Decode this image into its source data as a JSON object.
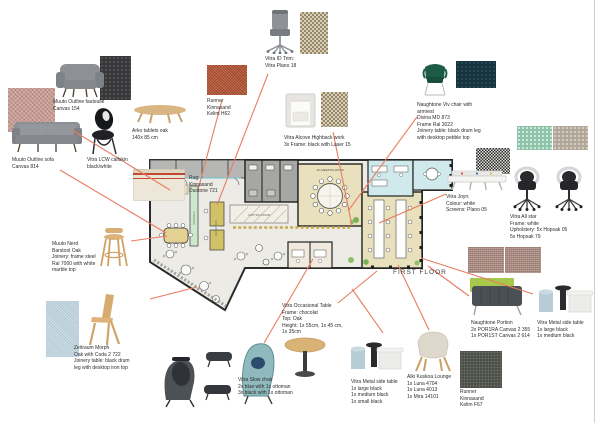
{
  "board": {
    "floor_label": "FIRST FLOOR",
    "accent_color": "#e87c5f",
    "plan": {
      "meeting_room": "12x MEETING ROOM",
      "copying_room": "COPYING ROOM",
      "reception": "RECEPTION",
      "entrance": "ENTRANCE"
    },
    "items": {
      "muuto_fauteuil": {
        "label": "Muuto Outline fauteuile\nCanvas 154"
      },
      "muuto_sofa": {
        "label": "Muuto Outline sofa\nCanvas 814"
      },
      "vitra_lcw": {
        "label": "Vitra LCW calfskin\nblack/white"
      },
      "arko": {
        "label": "Arko tablets oak\n140x 85 cm"
      },
      "runner_h62": {
        "label": "Runner\nKinnasand\nKelim H62"
      },
      "id_trim": {
        "label": "Vitra ID Trim:\nVitra Plano 18"
      },
      "alcove": {
        "label": "Vitra Alcove Highback work\n3x Frame: black with Laser 15"
      },
      "rug": {
        "label": "Rug:\nKinnasand\nDuotone 721"
      },
      "viv": {
        "label": "Naughtone Viv chair with\narmrest\nDivina MD 873\nFrame Ral 3022\nJoinery table: black drum leg\nwith desktop pebble top"
      },
      "joyn": {
        "label": "Vitra Joyn:\nColour: white\nScreens: Plano 05"
      },
      "allstar": {
        "label": "Vitra All star\nFrame: white",
        "label_bold": "Upholstery: 5x Hopsak 05\n5x Hopsak 79"
      },
      "nerd": {
        "label": "Muuto Nerd\nBarstool Oak\nJoinery: frame steel\nRal 7000 with white\nmarble top"
      },
      "morph": {
        "label": "Zeitraum Morph\nOak with Coda 2 722\nJoinery table: black drum\nleg with desktop iron top"
      },
      "slow": {
        "label": "Vitra Slow chair\n2x blue with 1x ottoman\n3x black with 1x ottoman"
      },
      "occasional": {
        "label": "Vitra Occasional Table\nFrame: chocolat\nTop: Oak\nHeight: 1x 55cm, 1x 45 cm,\n1x 35cm"
      },
      "metal_center": {
        "label": "Vitra Metal side table\n1x large black\n1x medium black\n1x small black"
      },
      "alki": {
        "label": "Alki Kuskoa Lounge\n1x Luna 4704\n1x Luna 4013\n1x Mira 14101"
      },
      "portion": {
        "label": "Naughtone Portion\n2x POR1RA Canvas 2 355\n1x POR1ST Canvas 2 614"
      },
      "metal_right": {
        "label": "Vitra Metal side table\n1x large black\n1x medium black"
      },
      "runner_f67": {
        "label": "Runner\nKinnasand\nKelim F67"
      }
    },
    "swatch_colors": {
      "canvas_154_pink": "#c79b94",
      "dark_knit": "#38383b",
      "kelim_h62_brick": "#b2502f",
      "laser_check_beige": "#94876a",
      "divina_navy": "#16323e",
      "hopsak_mint": "#8cc3a9",
      "hopsak_warm_gray": "#b2a89a",
      "plano_bw_check": "#2e2e2e",
      "hopsak_rosy": "#a8897f",
      "coda_light_blue": "#b0c8d3",
      "duotone_rug_cream": "#e9e4d3",
      "kelim_f67_green_gray": "#4b4f48"
    }
  }
}
